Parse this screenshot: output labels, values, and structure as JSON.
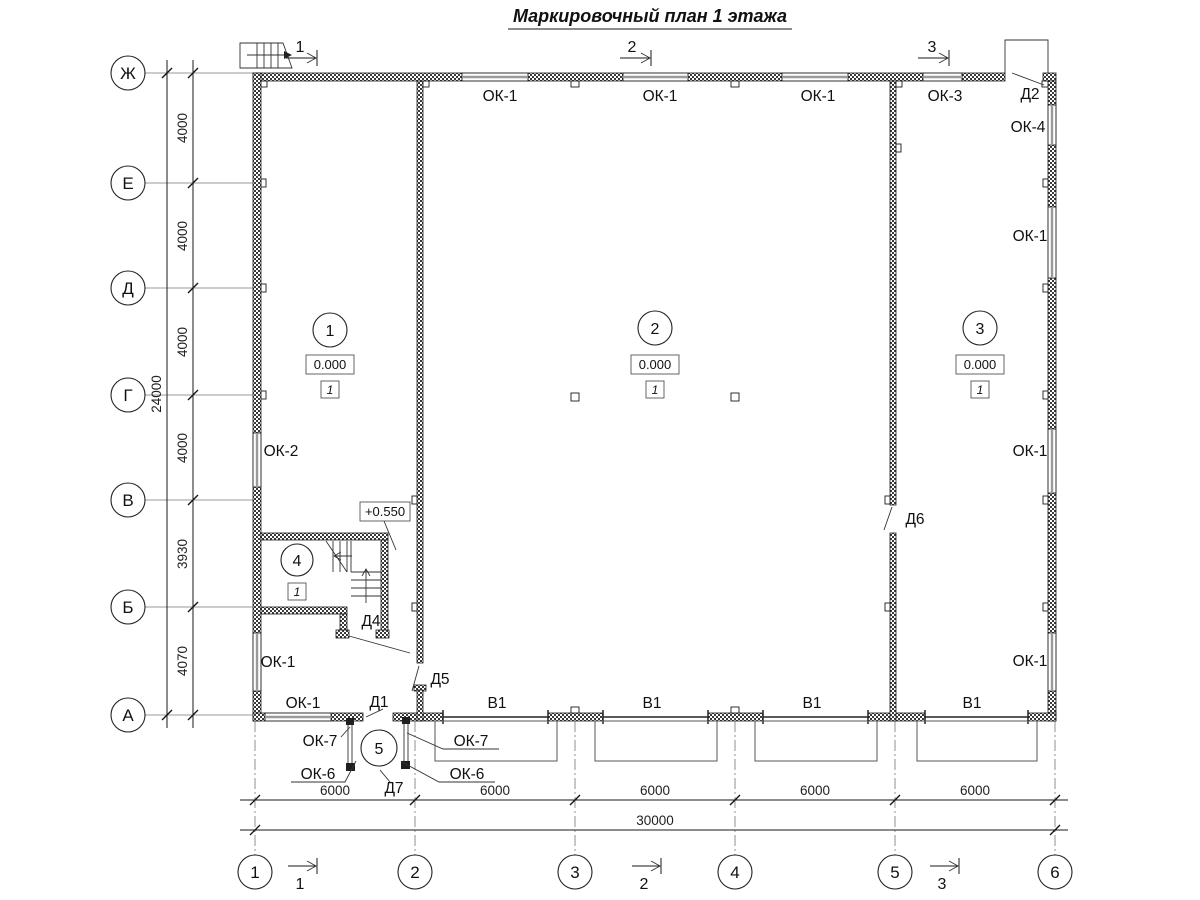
{
  "title": "Маркировочный план 1 этажа",
  "axes": {
    "rows": [
      "Ж",
      "Е",
      "Д",
      "Г",
      "В",
      "Б",
      "А"
    ],
    "row_dims": [
      "4000",
      "4000",
      "4000",
      "4000",
      "3930",
      "4070"
    ],
    "row_total": "24000",
    "cols": [
      "1",
      "2",
      "3",
      "4",
      "5",
      "6"
    ],
    "col_dims": [
      "6000",
      "6000",
      "6000",
      "6000",
      "6000"
    ],
    "col_total": "30000"
  },
  "sections": {
    "top": [
      "1",
      "2",
      "3"
    ],
    "bottom": [
      "1",
      "2",
      "3"
    ]
  },
  "rooms": {
    "r1": {
      "number": "1",
      "level": "0.000",
      "floor_type": "1"
    },
    "r2": {
      "number": "2",
      "level": "0.000",
      "floor_type": "1"
    },
    "r3": {
      "number": "3",
      "level": "0.000",
      "floor_type": "1"
    },
    "r4": {
      "number": "4",
      "floor_type": "1"
    },
    "r5": {
      "number": "5"
    }
  },
  "level_mark": "+0.550",
  "openings": {
    "top_windows": [
      "ОК-1",
      "ОК-1",
      "ОК-1",
      "ОК-3"
    ],
    "top_door": "Д2",
    "right_windows": [
      "ОК-4",
      "ОК-1",
      "ОК-1",
      "ОК-1"
    ],
    "left_windows": [
      "ОК-2",
      "ОК-1"
    ],
    "bottom_window": "ОК-1",
    "gates": [
      "В1",
      "В1",
      "В1",
      "В1"
    ],
    "doors": {
      "d1": "Д1",
      "d4": "Д4",
      "d5": "Д5",
      "d6": "Д6",
      "d7": "Д7"
    },
    "vestibule_windows": {
      "ok7_left": "ОК-7",
      "ok7_right": "ОК-7",
      "ok6_left": "ОК-6",
      "ok6_right": "ОК-6"
    }
  }
}
